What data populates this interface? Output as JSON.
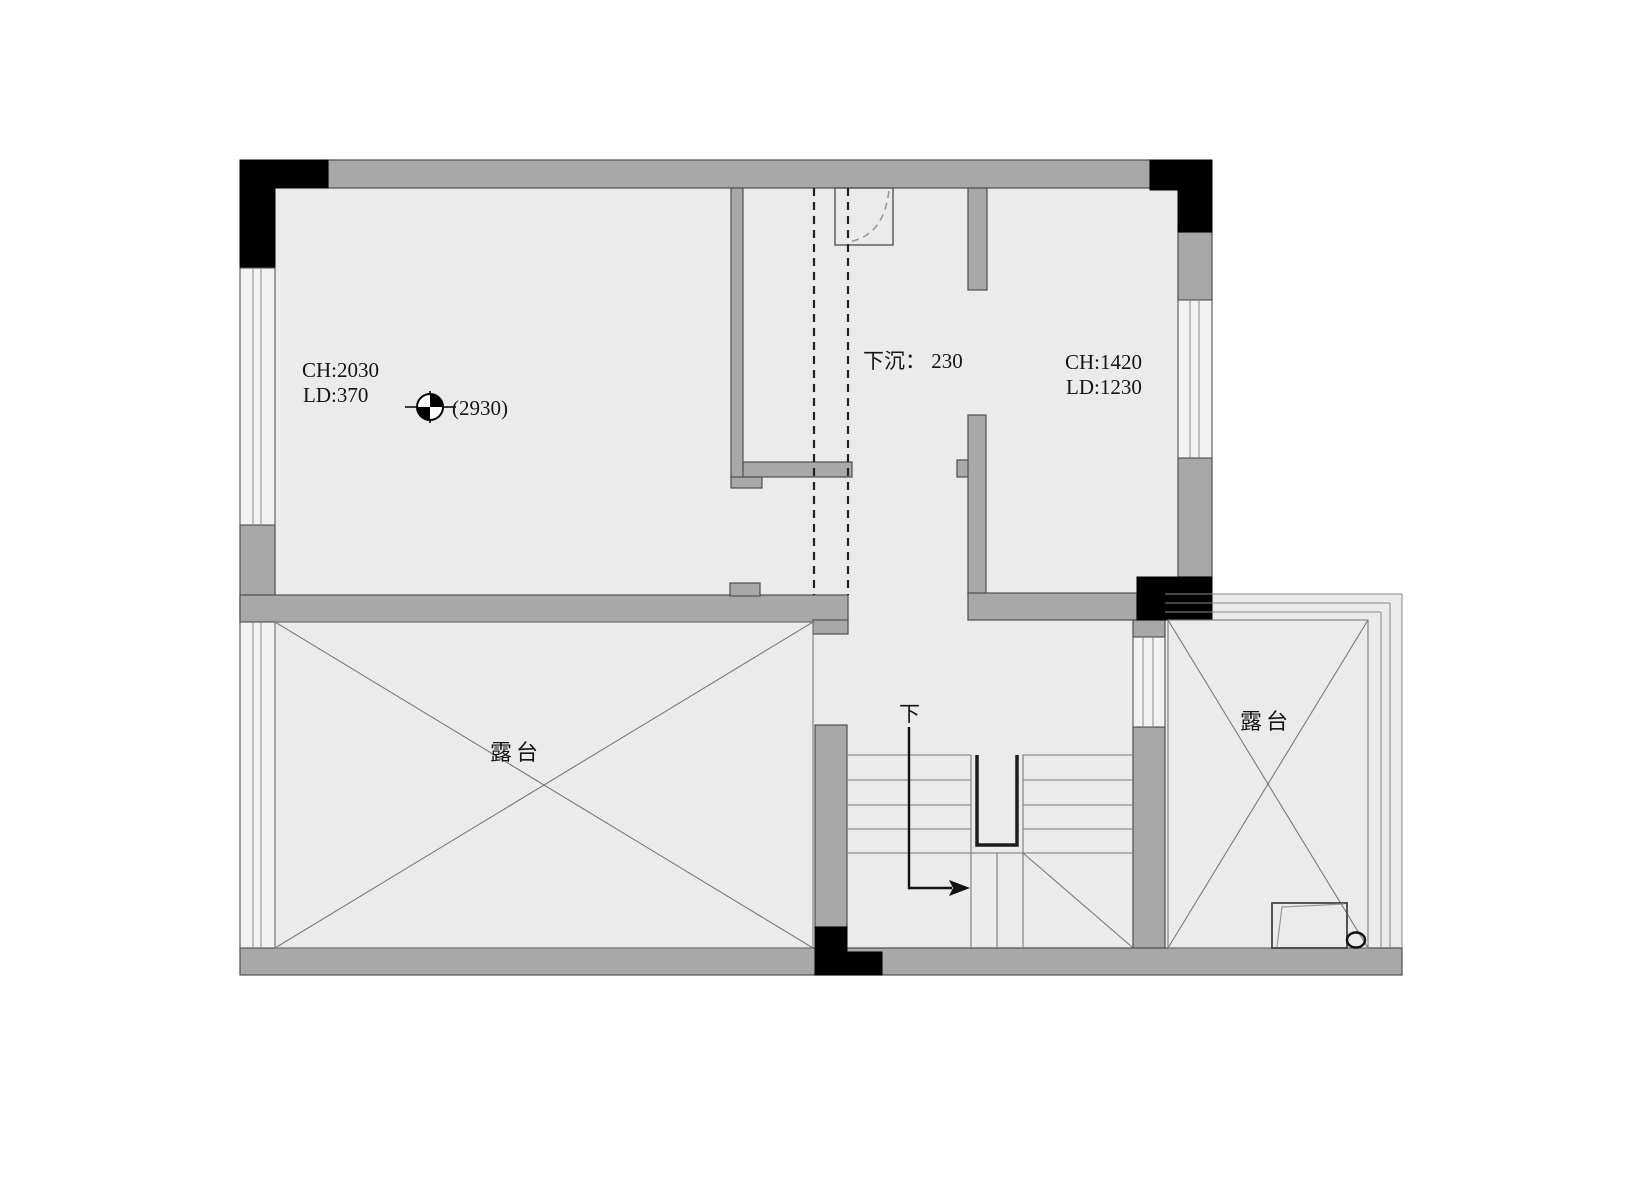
{
  "plan": {
    "type": "floor-plan",
    "rooms": {
      "upper_left": {
        "ch_label": "CH:2030",
        "ld_label": "LD:370",
        "level_label": "(2930)"
      },
      "sunken_corridor": {
        "label": "下沉： 230"
      },
      "upper_right": {
        "ch_label": "CH:1420",
        "ld_label": "LD:1230"
      },
      "terrace_left": {
        "label": "露台"
      },
      "terrace_right": {
        "label": "露台"
      },
      "stairs": {
        "direction_label": "下"
      }
    },
    "colors": {
      "background": "#ffffff",
      "interior": "#ebebeb",
      "wall": "#a8a8a8",
      "column": "#000000",
      "thin_line": "#777777",
      "dashed_line": "#222222",
      "text": "#151515"
    }
  }
}
